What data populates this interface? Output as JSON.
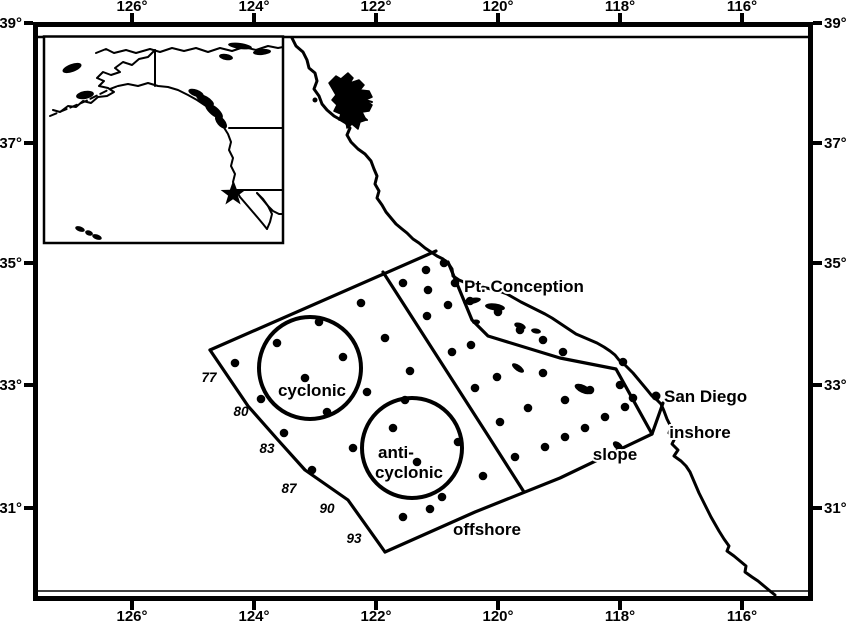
{
  "colors": {
    "ink": "#000000",
    "paper": "#ffffff"
  },
  "axis": {
    "lon_ticks": [
      {
        "label": "126°",
        "x": 132
      },
      {
        "label": "124°",
        "x": 254
      },
      {
        "label": "122°",
        "x": 376
      },
      {
        "label": "120°",
        "x": 498
      },
      {
        "label": "118°",
        "x": 620
      },
      {
        "label": "116°",
        "x": 742
      }
    ],
    "lat_ticks": [
      {
        "label": "39°",
        "y": 23
      },
      {
        "label": "37°",
        "y": 143
      },
      {
        "label": "35°",
        "y": 263
      },
      {
        "label": "33°",
        "y": 385
      },
      {
        "label": "31°",
        "y": 508
      }
    ]
  },
  "places": {
    "pt_conception": "Pt. Conception",
    "san_diego": "San Diego"
  },
  "region_labels": {
    "inshore": "inshore",
    "slope": "slope",
    "offshore": "offshore"
  },
  "eddy_labels": {
    "cyclonic": "cyclonic",
    "anticyclonic_line1": "anti-",
    "anticyclonic_line2": "cyclonic"
  },
  "map": {
    "line_numbers": [
      {
        "label": "77",
        "x": 209,
        "y": 377
      },
      {
        "label": "80",
        "x": 241,
        "y": 411
      },
      {
        "label": "83",
        "x": 267,
        "y": 448
      },
      {
        "label": "87",
        "x": 289,
        "y": 488
      },
      {
        "label": "90",
        "x": 327,
        "y": 508
      },
      {
        "label": "93",
        "x": 354,
        "y": 538
      }
    ],
    "boundaries": {
      "northeast-edge": [
        [
          210,
          350
        ],
        [
          436,
          251
        ]
      ],
      "west-edge": [
        [
          210,
          350
        ],
        [
          248,
          406
        ],
        [
          278,
          440
        ],
        [
          305,
          470
        ],
        [
          348,
          500
        ],
        [
          385,
          552
        ]
      ],
      "southeast-edge": [
        [
          385,
          552
        ],
        [
          475,
          512
        ],
        [
          560,
          478
        ],
        [
          652,
          434
        ],
        [
          663,
          403
        ]
      ],
      "offshore-slope-divider": [
        [
          383,
          272
        ],
        [
          487,
          434
        ],
        [
          524,
          492
        ]
      ],
      "slope-inshore-divider": [
        [
          448,
          262
        ],
        [
          472,
          320
        ],
        [
          488,
          336
        ],
        [
          560,
          358
        ],
        [
          616,
          369
        ],
        [
          652,
          434
        ]
      ]
    },
    "eddies": [
      {
        "id": "cyclonic",
        "cx": 310,
        "cy": 368,
        "r": 51
      },
      {
        "id": "anticyclonic",
        "cx": 412,
        "cy": 448,
        "r": 50
      }
    ],
    "stations": [
      [
        235,
        363
      ],
      [
        261,
        399
      ],
      [
        277,
        343
      ],
      [
        284,
        433
      ],
      [
        305,
        378
      ],
      [
        312,
        470
      ],
      [
        319,
        322
      ],
      [
        327,
        412
      ],
      [
        343,
        357
      ],
      [
        353,
        448
      ],
      [
        361,
        303
      ],
      [
        367,
        392
      ],
      [
        385,
        338
      ],
      [
        393,
        428
      ],
      [
        403,
        283
      ],
      [
        405,
        400
      ],
      [
        410,
        371
      ],
      [
        417,
        462
      ],
      [
        426,
        270
      ],
      [
        427,
        316
      ],
      [
        428,
        290
      ],
      [
        430,
        509
      ],
      [
        403,
        517
      ],
      [
        442,
        497
      ],
      [
        444,
        263
      ],
      [
        448,
        305
      ],
      [
        455,
        283
      ],
      [
        458,
        442
      ],
      [
        470,
        301
      ],
      [
        483,
        476
      ],
      [
        452,
        352
      ],
      [
        471,
        345
      ],
      [
        475,
        388
      ],
      [
        497,
        377
      ],
      [
        500,
        422
      ],
      [
        515,
        457
      ],
      [
        528,
        408
      ],
      [
        543,
        373
      ],
      [
        545,
        447
      ],
      [
        565,
        400
      ],
      [
        565,
        437
      ],
      [
        585,
        428
      ],
      [
        590,
        390
      ],
      [
        605,
        417
      ],
      [
        620,
        385
      ],
      [
        625,
        407
      ],
      [
        633,
        398
      ],
      [
        498,
        312
      ],
      [
        520,
        330
      ],
      [
        543,
        340
      ],
      [
        563,
        352
      ],
      [
        623,
        362
      ]
    ]
  }
}
